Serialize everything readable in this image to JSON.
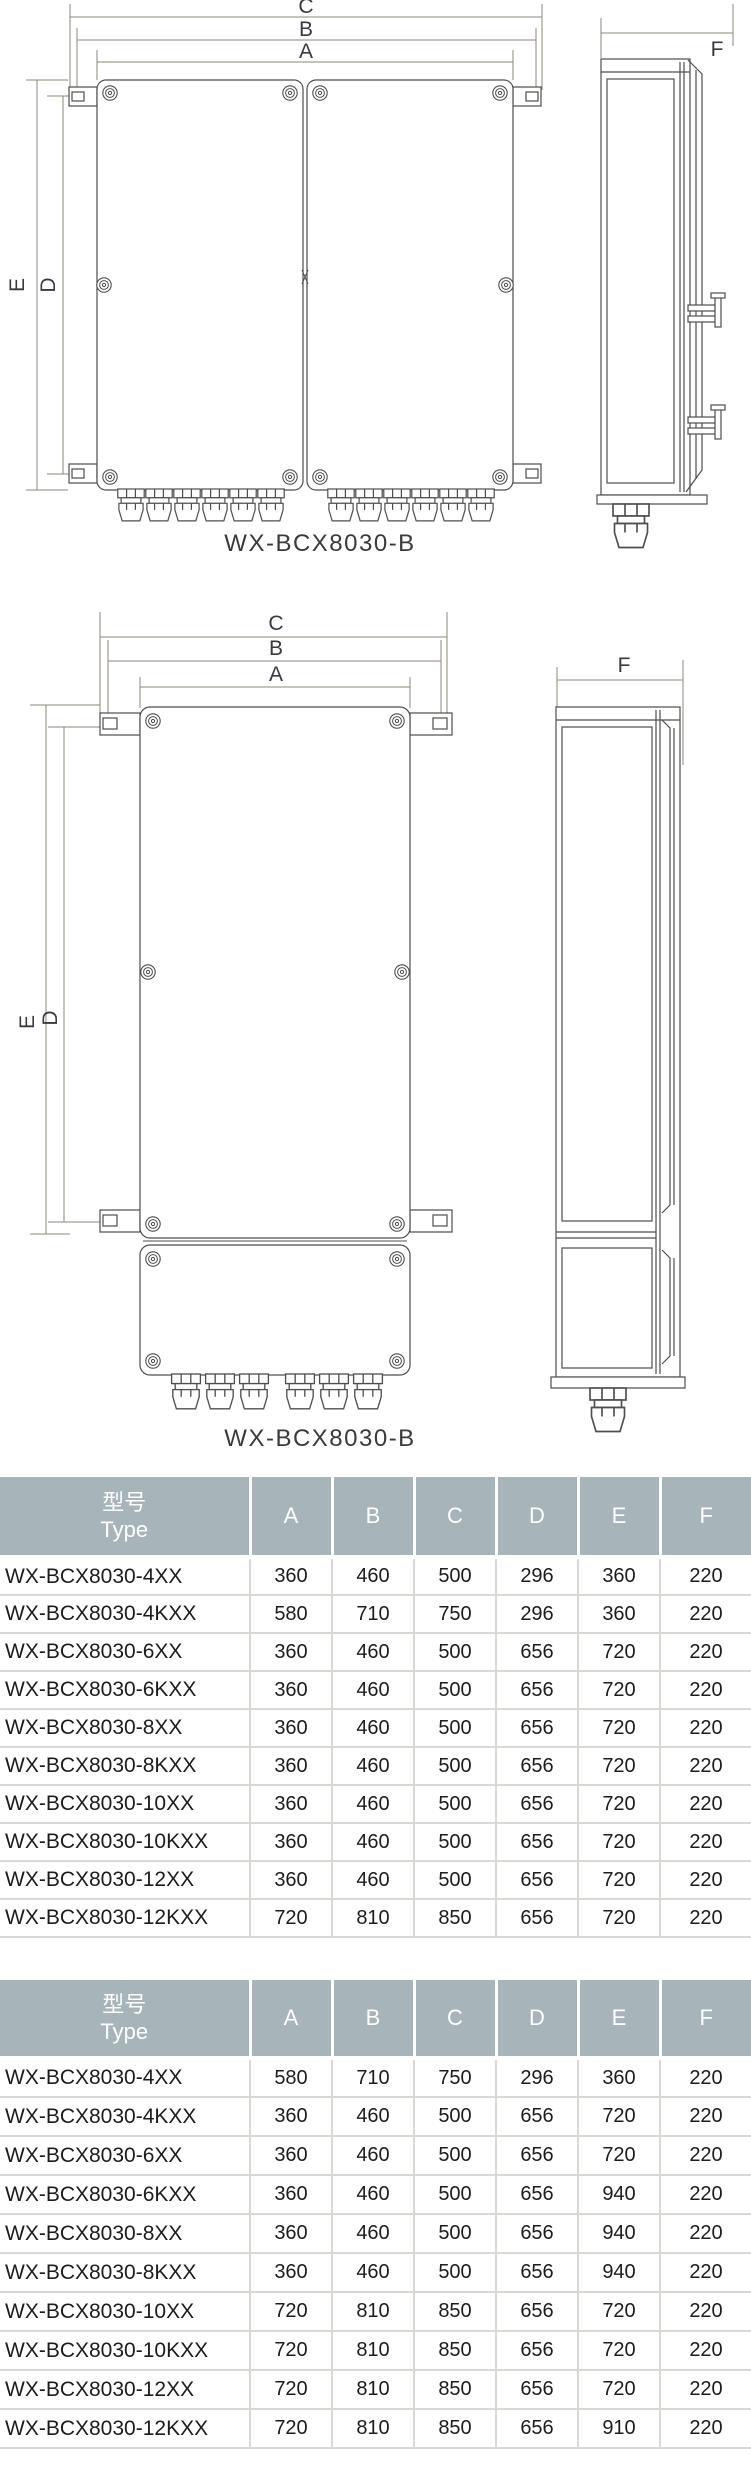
{
  "drawing1": {
    "caption": "WX-BCX8030-B",
    "dims": {
      "a": "A",
      "b": "B",
      "c": "C",
      "d": "D",
      "e": "E",
      "f": "F"
    }
  },
  "drawing2": {
    "caption": "WX-BCX8030-B",
    "dims": {
      "a": "A",
      "b": "B",
      "c": "C",
      "d": "D",
      "e": "E",
      "f": "F"
    }
  },
  "table1": {
    "header": {
      "type_zh": "型号",
      "type_en": "Type",
      "dims": [
        "A",
        "B",
        "C",
        "D",
        "E",
        "F"
      ]
    },
    "rows": [
      {
        "type": "WX-BCX8030-4XX",
        "values": [
          "360",
          "460",
          "500",
          "296",
          "360",
          "220"
        ]
      },
      {
        "type": "WX-BCX8030-4KXX",
        "values": [
          "580",
          "710",
          "750",
          "296",
          "360",
          "220"
        ]
      },
      {
        "type": "WX-BCX8030-6XX",
        "values": [
          "360",
          "460",
          "500",
          "656",
          "720",
          "220"
        ]
      },
      {
        "type": "WX-BCX8030-6KXX",
        "values": [
          "360",
          "460",
          "500",
          "656",
          "720",
          "220"
        ]
      },
      {
        "type": "WX-BCX8030-8XX",
        "values": [
          "360",
          "460",
          "500",
          "656",
          "720",
          "220"
        ]
      },
      {
        "type": "WX-BCX8030-8KXX",
        "values": [
          "360",
          "460",
          "500",
          "656",
          "720",
          "220"
        ]
      },
      {
        "type": "WX-BCX8030-10XX",
        "values": [
          "360",
          "460",
          "500",
          "656",
          "720",
          "220"
        ]
      },
      {
        "type": "WX-BCX8030-10KXX",
        "values": [
          "360",
          "460",
          "500",
          "656",
          "720",
          "220"
        ]
      },
      {
        "type": "WX-BCX8030-12XX",
        "values": [
          "360",
          "460",
          "500",
          "656",
          "720",
          "220"
        ]
      },
      {
        "type": "WX-BCX8030-12KXX",
        "values": [
          "720",
          "810",
          "850",
          "656",
          "720",
          "220"
        ]
      }
    ]
  },
  "table2": {
    "header": {
      "type_zh": "型号",
      "type_en": "Type",
      "dims": [
        "A",
        "B",
        "C",
        "D",
        "E",
        "F"
      ]
    },
    "rows": [
      {
        "type": "WX-BCX8030-4XX",
        "values": [
          "580",
          "710",
          "750",
          "296",
          "360",
          "220"
        ]
      },
      {
        "type": "WX-BCX8030-4KXX",
        "values": [
          "360",
          "460",
          "500",
          "656",
          "720",
          "220"
        ]
      },
      {
        "type": "WX-BCX8030-6XX",
        "values": [
          "360",
          "460",
          "500",
          "656",
          "720",
          "220"
        ]
      },
      {
        "type": "WX-BCX8030-6KXX",
        "values": [
          "360",
          "460",
          "500",
          "656",
          "940",
          "220"
        ]
      },
      {
        "type": "WX-BCX8030-8XX",
        "values": [
          "360",
          "460",
          "500",
          "656",
          "940",
          "220"
        ]
      },
      {
        "type": "WX-BCX8030-8KXX",
        "values": [
          "360",
          "460",
          "500",
          "656",
          "940",
          "220"
        ]
      },
      {
        "type": "WX-BCX8030-10XX",
        "values": [
          "720",
          "810",
          "850",
          "656",
          "720",
          "220"
        ]
      },
      {
        "type": "WX-BCX8030-10KXX",
        "values": [
          "720",
          "810",
          "850",
          "656",
          "720",
          "220"
        ]
      },
      {
        "type": "WX-BCX8030-12XX",
        "values": [
          "720",
          "810",
          "850",
          "656",
          "720",
          "220"
        ]
      },
      {
        "type": "WX-BCX8030-12KXX",
        "values": [
          "720",
          "810",
          "850",
          "656",
          "910",
          "220"
        ]
      }
    ]
  },
  "colors": {
    "table_header_bg": "#a7b4ba",
    "table_header_text": "#ffffff",
    "drawing_line": "#4e4e4c",
    "dimension_line": "#8e8478",
    "table_border": "#dbd8d3",
    "body_text": "#1c1c1c"
  }
}
